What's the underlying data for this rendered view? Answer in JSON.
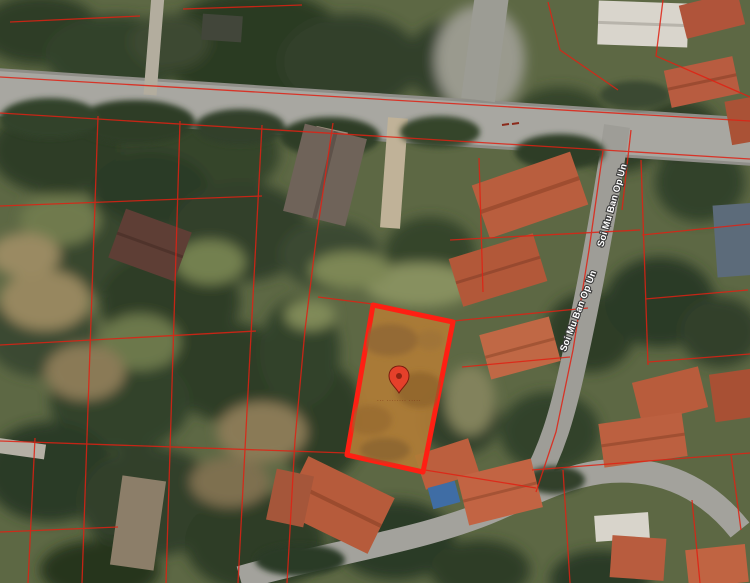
{
  "map": {
    "street_labels": {
      "first": "Soi Mu Ban Op Un",
      "second": "Soi Mu Ban Op Un"
    },
    "selected_parcel": {
      "caption": "··· ········ ·····",
      "fill_color": "#b07c36",
      "border_color": "#ff1f13"
    },
    "pin_color": "#e5402a",
    "boundary_color": "#e02113"
  }
}
